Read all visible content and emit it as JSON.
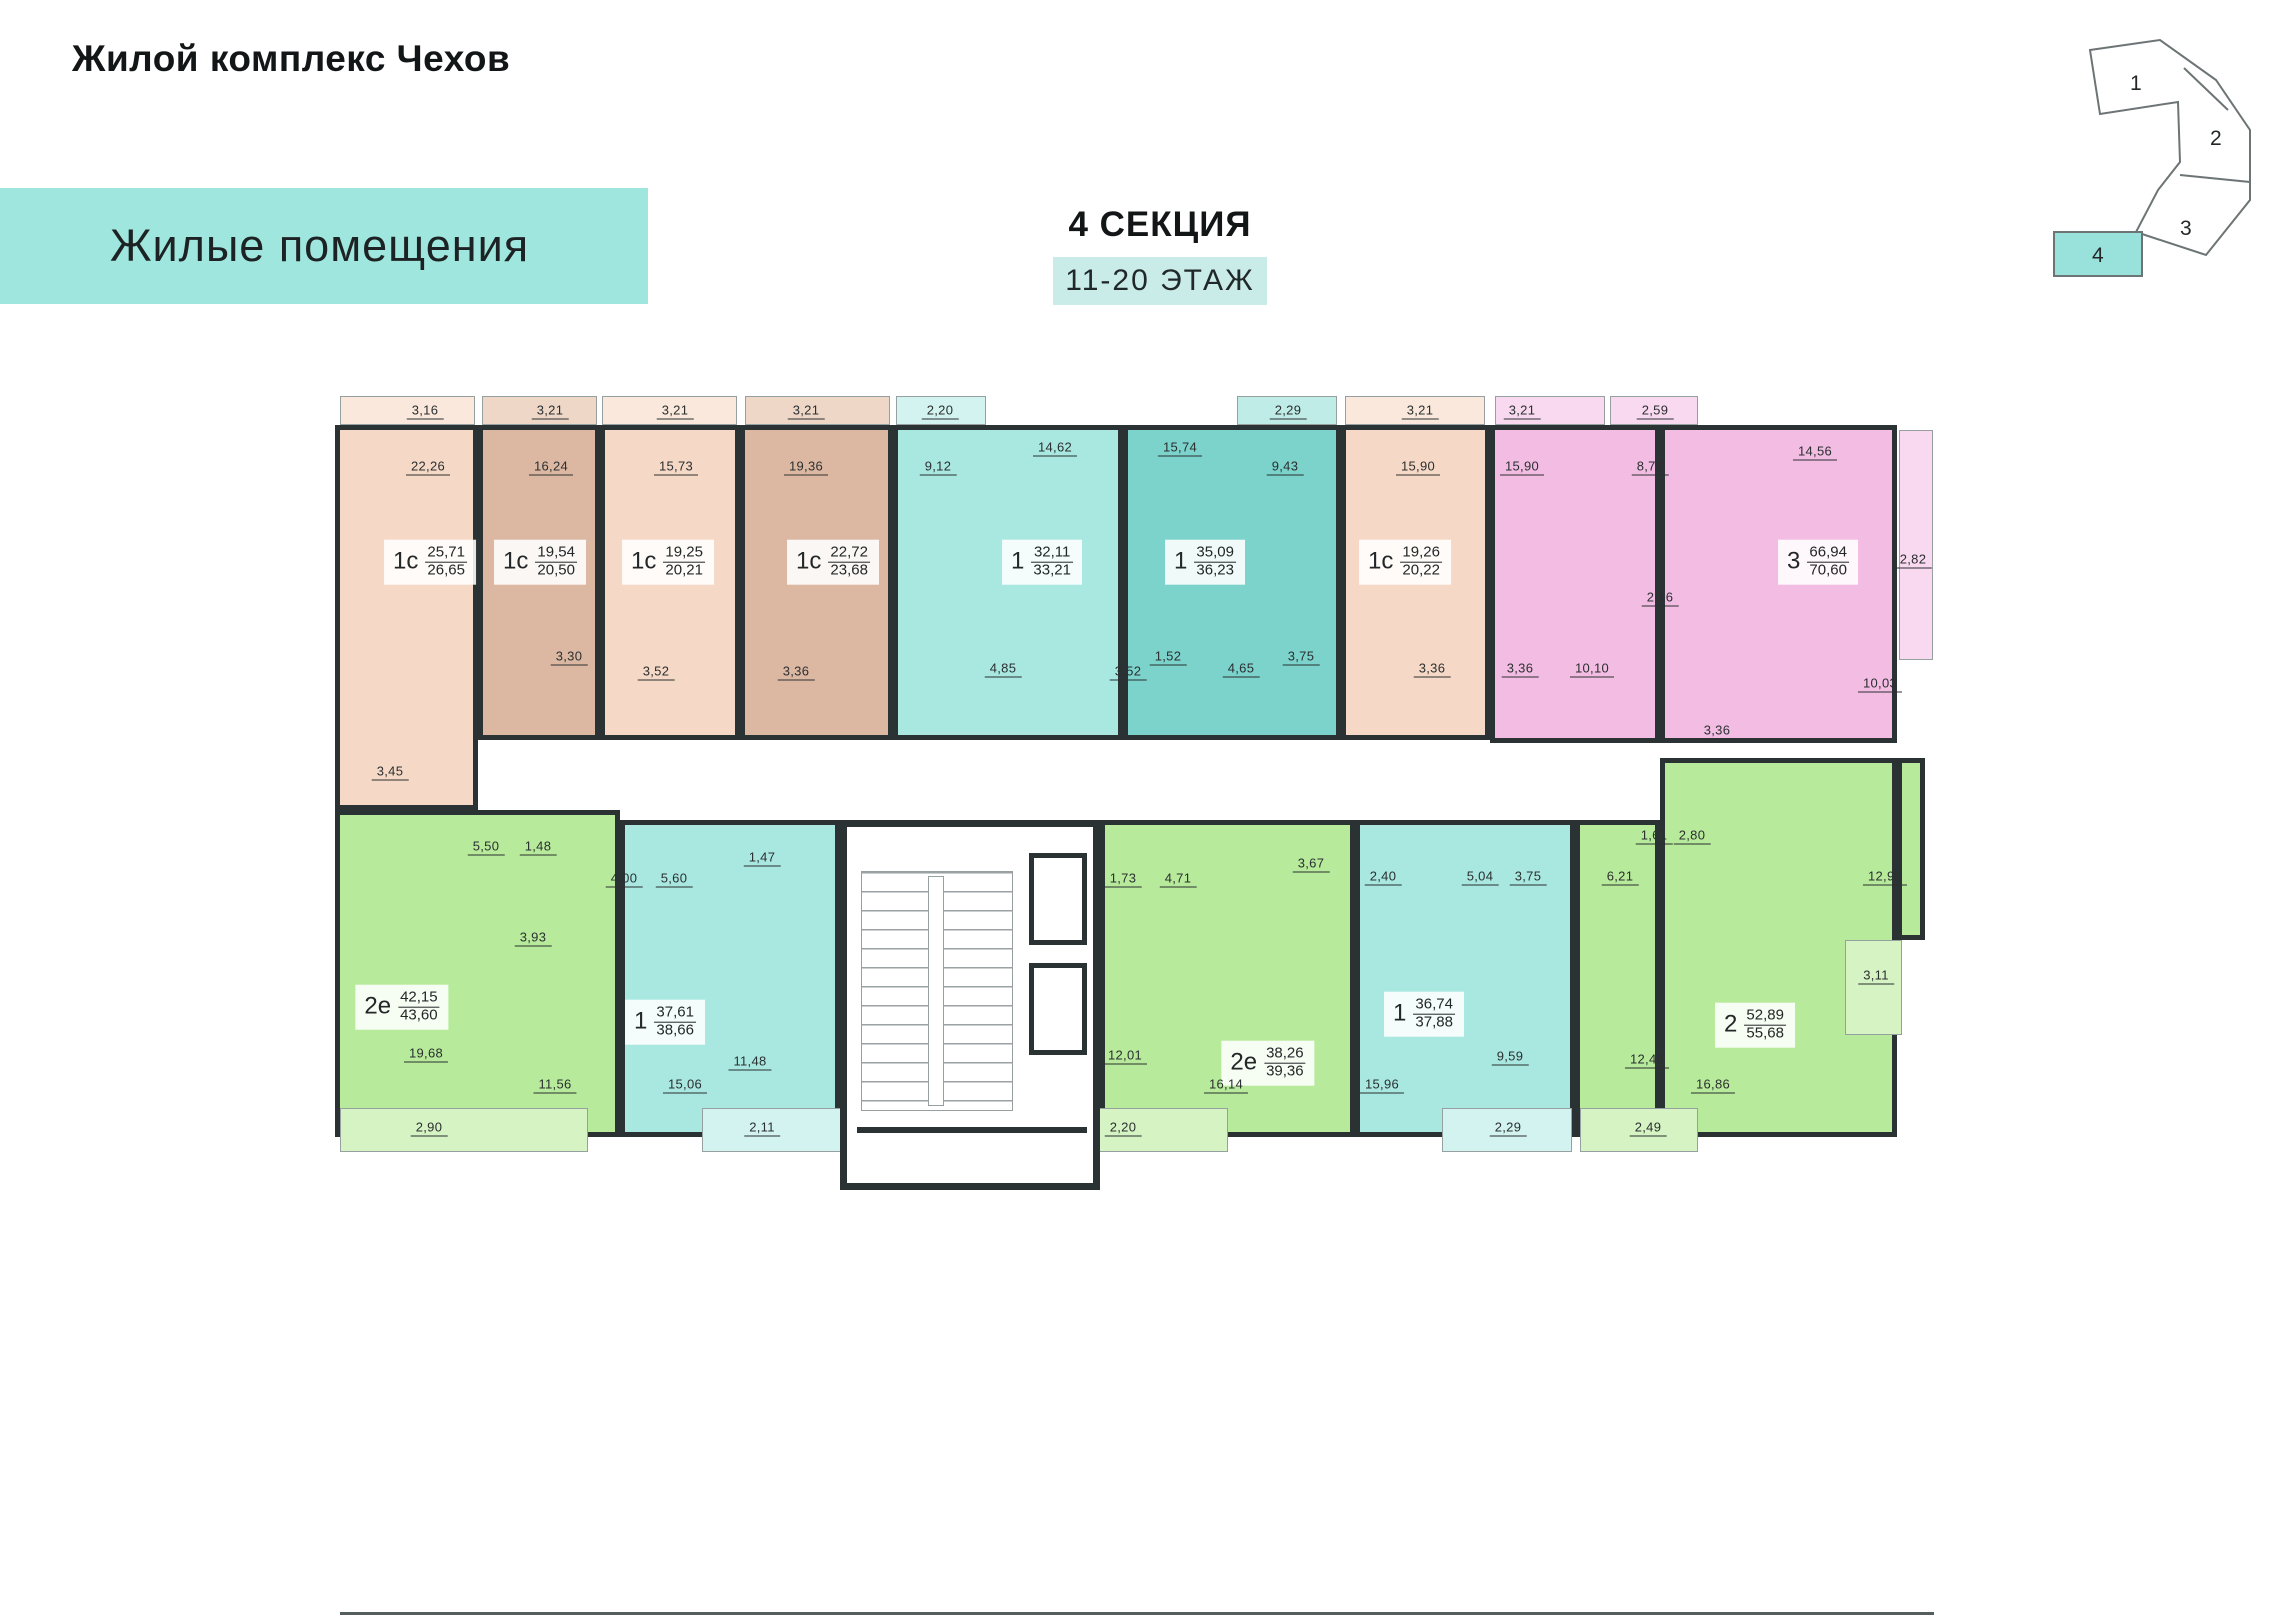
{
  "header": {
    "title": "Жилой комплекс Чехов",
    "banner": "Жилые помещения",
    "section": "4 СЕКЦИЯ",
    "floors": "11-20 ЭТАЖ"
  },
  "minimap": {
    "sections": [
      "1",
      "2",
      "3",
      "4"
    ],
    "active_section": "4",
    "active_color": "#99e2dc"
  },
  "colors": {
    "banner": "#9fe7de",
    "floors_box": "#c9ece8",
    "wall": "#2b3233",
    "beige": "#f5d9c6",
    "tan": "#dcb8a3",
    "teal": "#a9e8e1",
    "teal_dark": "#7bd3cb",
    "pink": "#f3bde3",
    "green": "#b7eb9b"
  },
  "plan": {
    "apartments": [
      {
        "id": "u1",
        "type": "1с",
        "a1": "25,71",
        "a2": "26,65",
        "color": "beige",
        "label": [
          430,
          562
        ],
        "rects": [
          [
            335,
            425,
            143,
            385
          ]
        ]
      },
      {
        "id": "u2",
        "type": "1с",
        "a1": "19,54",
        "a2": "20,50",
        "color": "tan",
        "label": [
          540,
          562
        ],
        "rects": [
          [
            478,
            425,
            122,
            315
          ]
        ]
      },
      {
        "id": "u3",
        "type": "1с",
        "a1": "19,25",
        "a2": "20,21",
        "color": "beige",
        "label": [
          668,
          562
        ],
        "rects": [
          [
            600,
            425,
            140,
            315
          ]
        ]
      },
      {
        "id": "u4",
        "type": "1с",
        "a1": "22,72",
        "a2": "23,68",
        "color": "tan",
        "label": [
          833,
          562
        ],
        "rects": [
          [
            740,
            425,
            153,
            315
          ]
        ]
      },
      {
        "id": "u5",
        "type": "1",
        "a1": "32,11",
        "a2": "33,21",
        "color": "teal",
        "label": [
          1042,
          562
        ],
        "rects": [
          [
            893,
            425,
            230,
            315
          ]
        ]
      },
      {
        "id": "u6",
        "type": "1",
        "a1": "35,09",
        "a2": "36,23",
        "color": "tealdark",
        "label": [
          1205,
          562
        ],
        "rects": [
          [
            1123,
            425,
            218,
            315
          ]
        ]
      },
      {
        "id": "u7",
        "type": "1с",
        "a1": "19,26",
        "a2": "20,22",
        "color": "beige",
        "label": [
          1405,
          562
        ],
        "rects": [
          [
            1341,
            425,
            149,
            315
          ]
        ]
      },
      {
        "id": "u8",
        "type": "3",
        "a1": "66,94",
        "a2": "70,60",
        "color": "pink",
        "label": [
          1818,
          562
        ],
        "rects": [
          [
            1490,
            425,
            170,
            318
          ],
          [
            1660,
            425,
            237,
            318
          ]
        ]
      },
      {
        "id": "l1",
        "type": "2е",
        "a1": "42,15",
        "a2": "43,60",
        "color": "green",
        "label": [
          402,
          1007
        ],
        "rects": [
          [
            335,
            810,
            285,
            327
          ]
        ]
      },
      {
        "id": "l2",
        "type": "1",
        "a1": "37,61",
        "a2": "38,66",
        "color": "teal",
        "label": [
          665,
          1022
        ],
        "rects": [
          [
            620,
            820,
            220,
            317
          ]
        ]
      },
      {
        "id": "l3",
        "type": "2е",
        "a1": "38,26",
        "a2": "39,36",
        "color": "green",
        "label": [
          1268,
          1063
        ],
        "rects": [
          [
            1100,
            820,
            255,
            317
          ]
        ]
      },
      {
        "id": "l4",
        "type": "1",
        "a1": "36,74",
        "a2": "37,88",
        "color": "teal",
        "label": [
          1424,
          1014
        ],
        "rects": [
          [
            1355,
            820,
            220,
            317
          ]
        ]
      },
      {
        "id": "l5",
        "type": "2",
        "a1": "52,89",
        "a2": "55,68",
        "color": "green",
        "label": [
          1755,
          1025
        ],
        "rects": [
          [
            1575,
            820,
            85,
            317
          ],
          [
            1660,
            758,
            237,
            379
          ],
          [
            1897,
            758,
            28,
            182
          ]
        ]
      }
    ],
    "balconies": [
      {
        "color": "beigeL",
        "r": [
          340,
          396,
          135,
          29
        ]
      },
      {
        "color": "tanL",
        "r": [
          482,
          396,
          115,
          29
        ]
      },
      {
        "color": "beigeL",
        "r": [
          602,
          396,
          135,
          29
        ]
      },
      {
        "color": "tanL",
        "r": [
          745,
          396,
          145,
          29
        ]
      },
      {
        "color": "tealL",
        "r": [
          896,
          396,
          90,
          29
        ]
      },
      {
        "color": "tealdarkL",
        "r": [
          1237,
          396,
          100,
          29
        ]
      },
      {
        "color": "beigeL",
        "r": [
          1345,
          396,
          140,
          29
        ]
      },
      {
        "color": "pinkL",
        "r": [
          1495,
          396,
          110,
          29
        ]
      },
      {
        "color": "pinkL",
        "r": [
          1610,
          396,
          88,
          29
        ]
      },
      {
        "color": "pinkL",
        "r": [
          1899,
          430,
          34,
          230
        ]
      },
      {
        "color": "greenL",
        "r": [
          340,
          1108,
          248,
          44
        ]
      },
      {
        "color": "tealL",
        "r": [
          702,
          1108,
          140,
          44
        ]
      },
      {
        "color": "greenL",
        "r": [
          1062,
          1108,
          166,
          44
        ]
      },
      {
        "color": "tealL",
        "r": [
          1442,
          1108,
          130,
          44
        ]
      },
      {
        "color": "greenL",
        "r": [
          1580,
          1108,
          118,
          44
        ]
      },
      {
        "color": "greenL",
        "r": [
          1845,
          940,
          57,
          95
        ]
      }
    ],
    "room_labels": [
      {
        "v": "3,16",
        "x": 425,
        "y": 411
      },
      {
        "v": "3,21",
        "x": 550,
        "y": 411
      },
      {
        "v": "3,21",
        "x": 675,
        "y": 411
      },
      {
        "v": "3,21",
        "x": 806,
        "y": 411
      },
      {
        "v": "2,20",
        "x": 940,
        "y": 411
      },
      {
        "v": "2,29",
        "x": 1288,
        "y": 411
      },
      {
        "v": "3,21",
        "x": 1420,
        "y": 411
      },
      {
        "v": "3,21",
        "x": 1522,
        "y": 411
      },
      {
        "v": "2,59",
        "x": 1655,
        "y": 411
      },
      {
        "v": "22,26",
        "x": 428,
        "y": 467
      },
      {
        "v": "16,24",
        "x": 551,
        "y": 467
      },
      {
        "v": "15,73",
        "x": 676,
        "y": 467
      },
      {
        "v": "19,36",
        "x": 806,
        "y": 467
      },
      {
        "v": "9,12",
        "x": 938,
        "y": 467
      },
      {
        "v": "14,62",
        "x": 1055,
        "y": 448
      },
      {
        "v": "15,74",
        "x": 1180,
        "y": 448
      },
      {
        "v": "9,43",
        "x": 1285,
        "y": 467
      },
      {
        "v": "15,90",
        "x": 1418,
        "y": 467
      },
      {
        "v": "15,90",
        "x": 1522,
        "y": 467
      },
      {
        "v": "8,76",
        "x": 1650,
        "y": 467
      },
      {
        "v": "14,56",
        "x": 1815,
        "y": 452
      },
      {
        "v": "2,82",
        "x": 1913,
        "y": 560
      },
      {
        "v": "3,45",
        "x": 390,
        "y": 772
      },
      {
        "v": "3,30",
        "x": 569,
        "y": 657
      },
      {
        "v": "3,52",
        "x": 656,
        "y": 672
      },
      {
        "v": "3,36",
        "x": 796,
        "y": 672
      },
      {
        "v": "4,85",
        "x": 1003,
        "y": 669
      },
      {
        "v": "3,52",
        "x": 1128,
        "y": 672
      },
      {
        "v": "1,52",
        "x": 1168,
        "y": 657
      },
      {
        "v": "4,65",
        "x": 1241,
        "y": 669
      },
      {
        "v": "3,75",
        "x": 1301,
        "y": 657
      },
      {
        "v": "3,36",
        "x": 1432,
        "y": 669
      },
      {
        "v": "3,36",
        "x": 1520,
        "y": 669
      },
      {
        "v": "10,10",
        "x": 1592,
        "y": 669
      },
      {
        "v": "2,16",
        "x": 1660,
        "y": 598
      },
      {
        "v": "3,36",
        "x": 1717,
        "y": 731
      },
      {
        "v": "10,03",
        "x": 1880,
        "y": 684
      },
      {
        "v": "5,50",
        "x": 486,
        "y": 847
      },
      {
        "v": "1,48",
        "x": 538,
        "y": 847
      },
      {
        "v": "3,93",
        "x": 533,
        "y": 938
      },
      {
        "v": "19,68",
        "x": 426,
        "y": 1054
      },
      {
        "v": "11,56",
        "x": 555,
        "y": 1085
      },
      {
        "v": "2,90",
        "x": 429,
        "y": 1128
      },
      {
        "v": "4,00",
        "x": 624,
        "y": 879
      },
      {
        "v": "5,60",
        "x": 674,
        "y": 879
      },
      {
        "v": "1,47",
        "x": 762,
        "y": 858
      },
      {
        "v": "11,48",
        "x": 750,
        "y": 1062
      },
      {
        "v": "15,06",
        "x": 685,
        "y": 1085
      },
      {
        "v": "2,11",
        "x": 762,
        "y": 1128
      },
      {
        "v": "1,73",
        "x": 1123,
        "y": 879
      },
      {
        "v": "4,71",
        "x": 1178,
        "y": 879
      },
      {
        "v": "3,67",
        "x": 1311,
        "y": 864
      },
      {
        "v": "12,01",
        "x": 1125,
        "y": 1056
      },
      {
        "v": "16,14",
        "x": 1226,
        "y": 1085
      },
      {
        "v": "2,20",
        "x": 1123,
        "y": 1128
      },
      {
        "v": "2,40",
        "x": 1383,
        "y": 877
      },
      {
        "v": "5,04",
        "x": 1480,
        "y": 877
      },
      {
        "v": "3,75",
        "x": 1528,
        "y": 877
      },
      {
        "v": "15,96",
        "x": 1382,
        "y": 1085
      },
      {
        "v": "9,59",
        "x": 1510,
        "y": 1057
      },
      {
        "v": "2,29",
        "x": 1508,
        "y": 1128
      },
      {
        "v": "6,21",
        "x": 1620,
        "y": 877
      },
      {
        "v": "1,61",
        "x": 1654,
        "y": 836
      },
      {
        "v": "2,80",
        "x": 1692,
        "y": 836
      },
      {
        "v": "12,46",
        "x": 1647,
        "y": 1060
      },
      {
        "v": "16,86",
        "x": 1713,
        "y": 1085
      },
      {
        "v": "2,49",
        "x": 1648,
        "y": 1128
      },
      {
        "v": "12,95",
        "x": 1885,
        "y": 877
      },
      {
        "v": "3,11",
        "x": 1876,
        "y": 976
      }
    ]
  }
}
